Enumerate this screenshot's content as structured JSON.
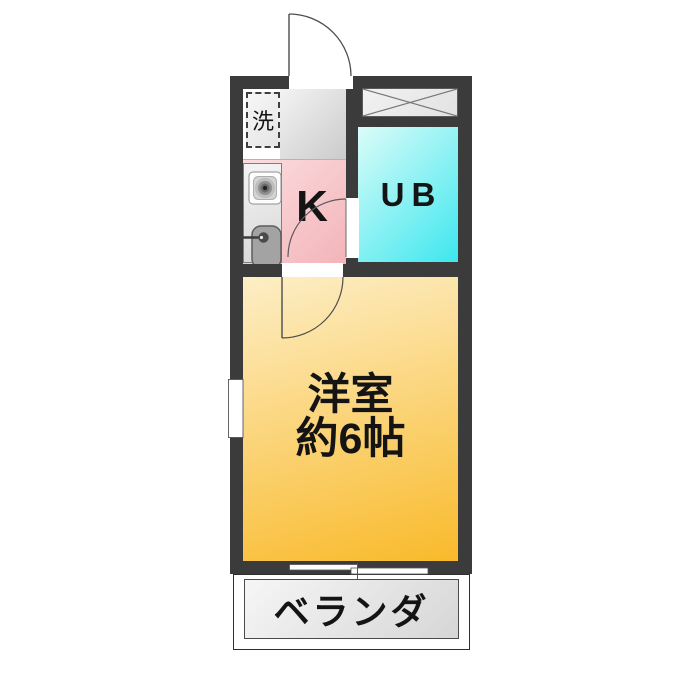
{
  "floorplan": {
    "labels": {
      "washer": "洗",
      "kitchen": "K",
      "bath": "UB",
      "room_line1": "洋室",
      "room_line2": "約6帖",
      "veranda": "ベランダ"
    },
    "colors": {
      "wall": "#3b3b3b",
      "kitchen_pink_light": "#fbdee0",
      "kitchen_pink_dark": "#f3b4b9",
      "bath_cyan_light": "#dbfcf9",
      "bath_cyan_dark": "#3de7ee",
      "room_orange_light": "#fdeec6",
      "room_orange_dark": "#f9ba2b",
      "entry_gray_light": "#f3f3f3",
      "entry_gray_dark": "#cbcbcb",
      "veranda_gray_light": "#f6f6f6",
      "veranda_gray_dark": "#d6d6d6"
    }
  }
}
